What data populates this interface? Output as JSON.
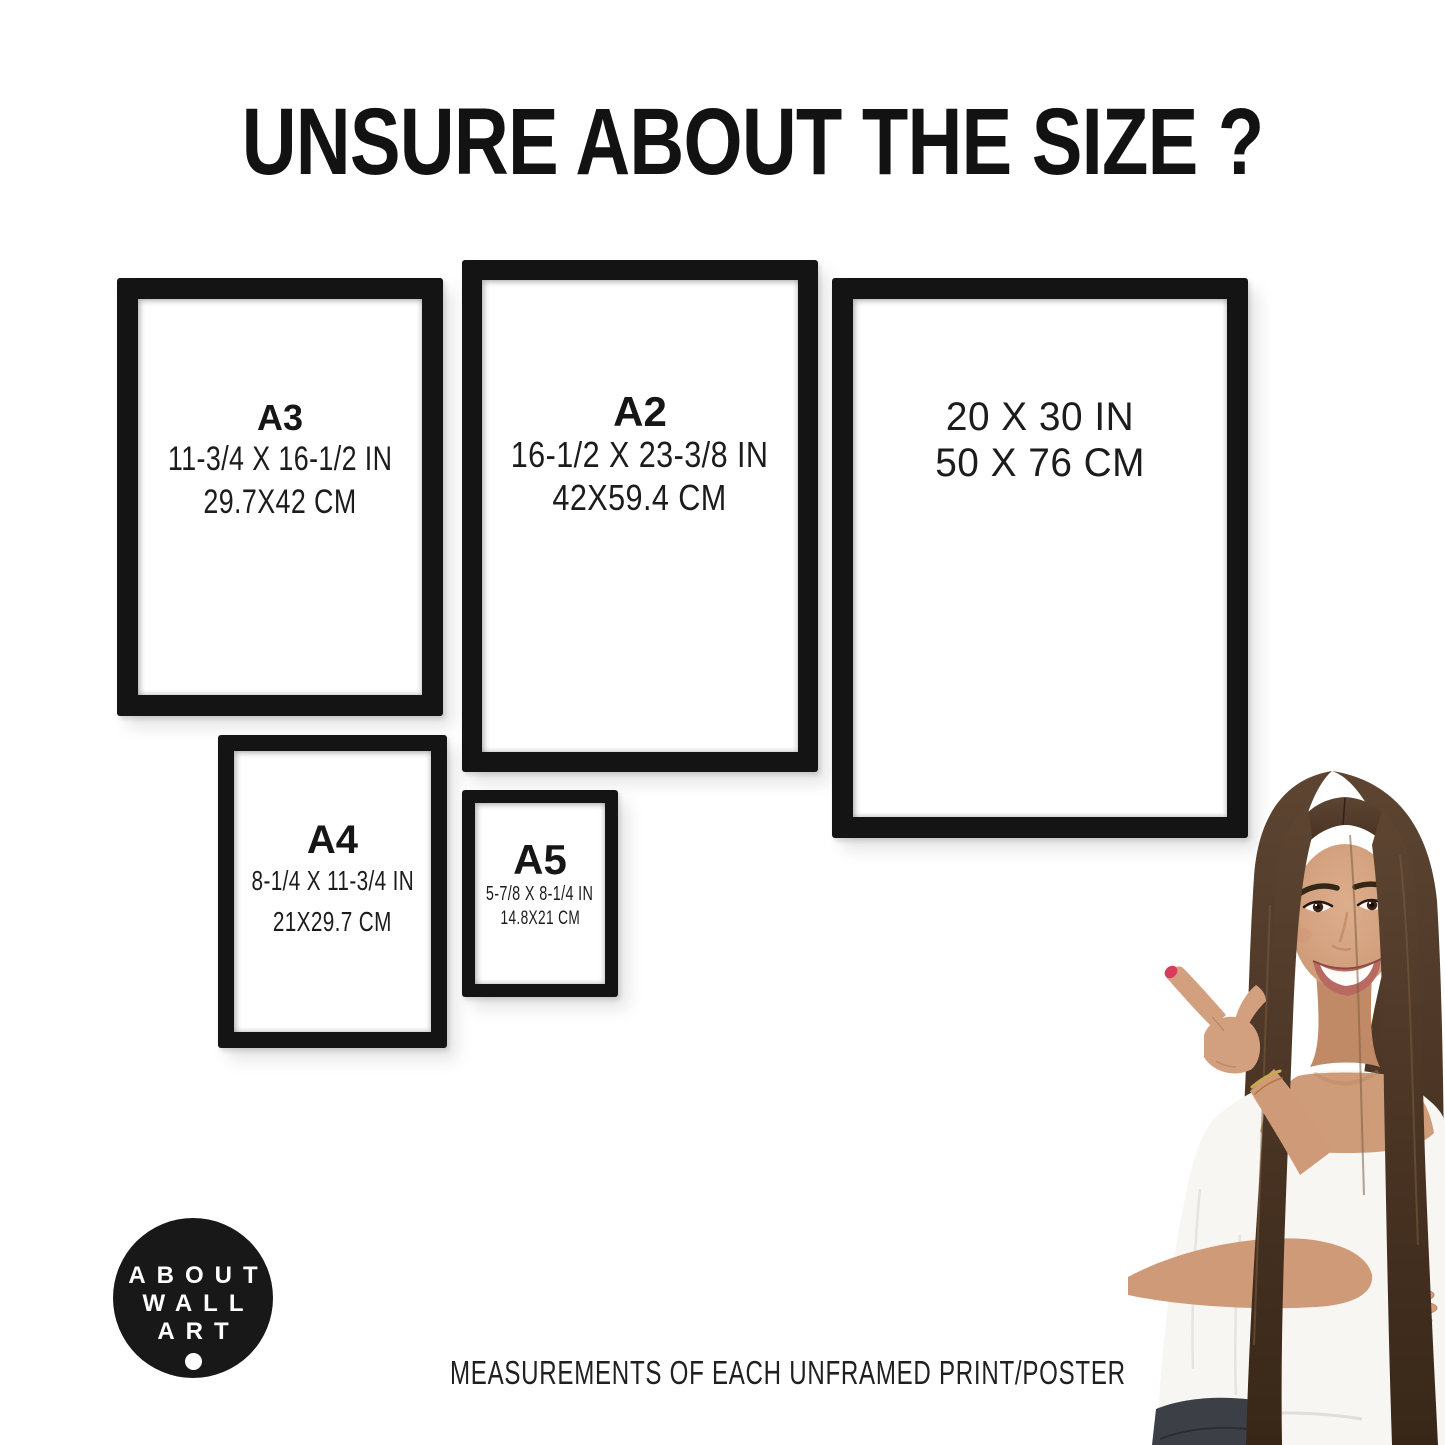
{
  "page": {
    "title": "UNSURE ABOUT THE SIZE ?",
    "caption": "MEASUREMENTS OF EACH UNFRAMED PRINT/POSTER"
  },
  "frames": [
    {
      "label": "A3",
      "inches": "11-3/4 X 16-1/2 IN",
      "cm": "29.7X42 CM"
    },
    {
      "label": "A2",
      "inches": "16-1/2 X 23-3/8 IN",
      "cm": "42X59.4 CM"
    },
    {
      "label": "",
      "inches": "20 X 30 IN",
      "cm": "50 X 76 CM"
    },
    {
      "label": "A4",
      "inches": "8-1/4 X 11-3/4 IN",
      "cm": "21X29.7 CM"
    },
    {
      "label": "A5",
      "inches": "5-7/8 X 8-1/4 IN",
      "cm": "14.8X21 CM"
    }
  ],
  "logo": {
    "line1": "ABOUT",
    "line2": "WALL",
    "line3": "ART"
  },
  "colors": {
    "background": "#ffffff",
    "frame_black": "#141414",
    "text": "#1a1a1a",
    "logo_bg": "#181818",
    "logo_text": "#ffffff",
    "hair_brown": "#4e3828",
    "skin_tan": "#d3a07f",
    "blouse_white": "#f7f6f3",
    "nail_polish_red": "#d93a5e",
    "jeans_dark": "#3c4046"
  }
}
